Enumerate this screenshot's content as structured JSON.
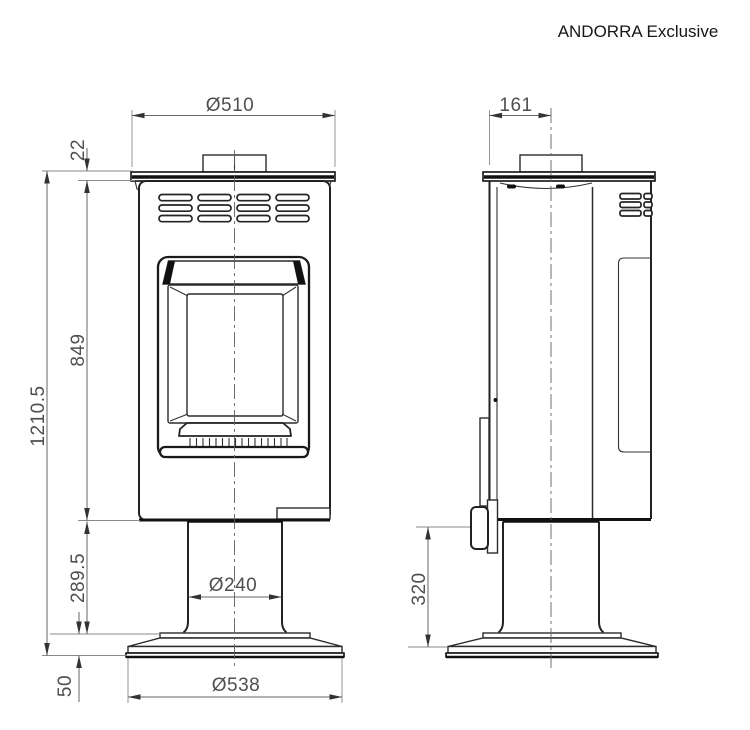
{
  "title": "ANDORRA Exclusive",
  "dimensions": {
    "front_top_diameter": "Ø510",
    "flue_center_offset": "161",
    "top_plate_thickness": "22",
    "body_height": "849",
    "total_height": "1210.5",
    "pedestal_height": "289.5",
    "pedestal_diameter": "Ø240",
    "handle_to_floor": "320",
    "base_diameter": "Ø538",
    "base_height": "50"
  }
}
